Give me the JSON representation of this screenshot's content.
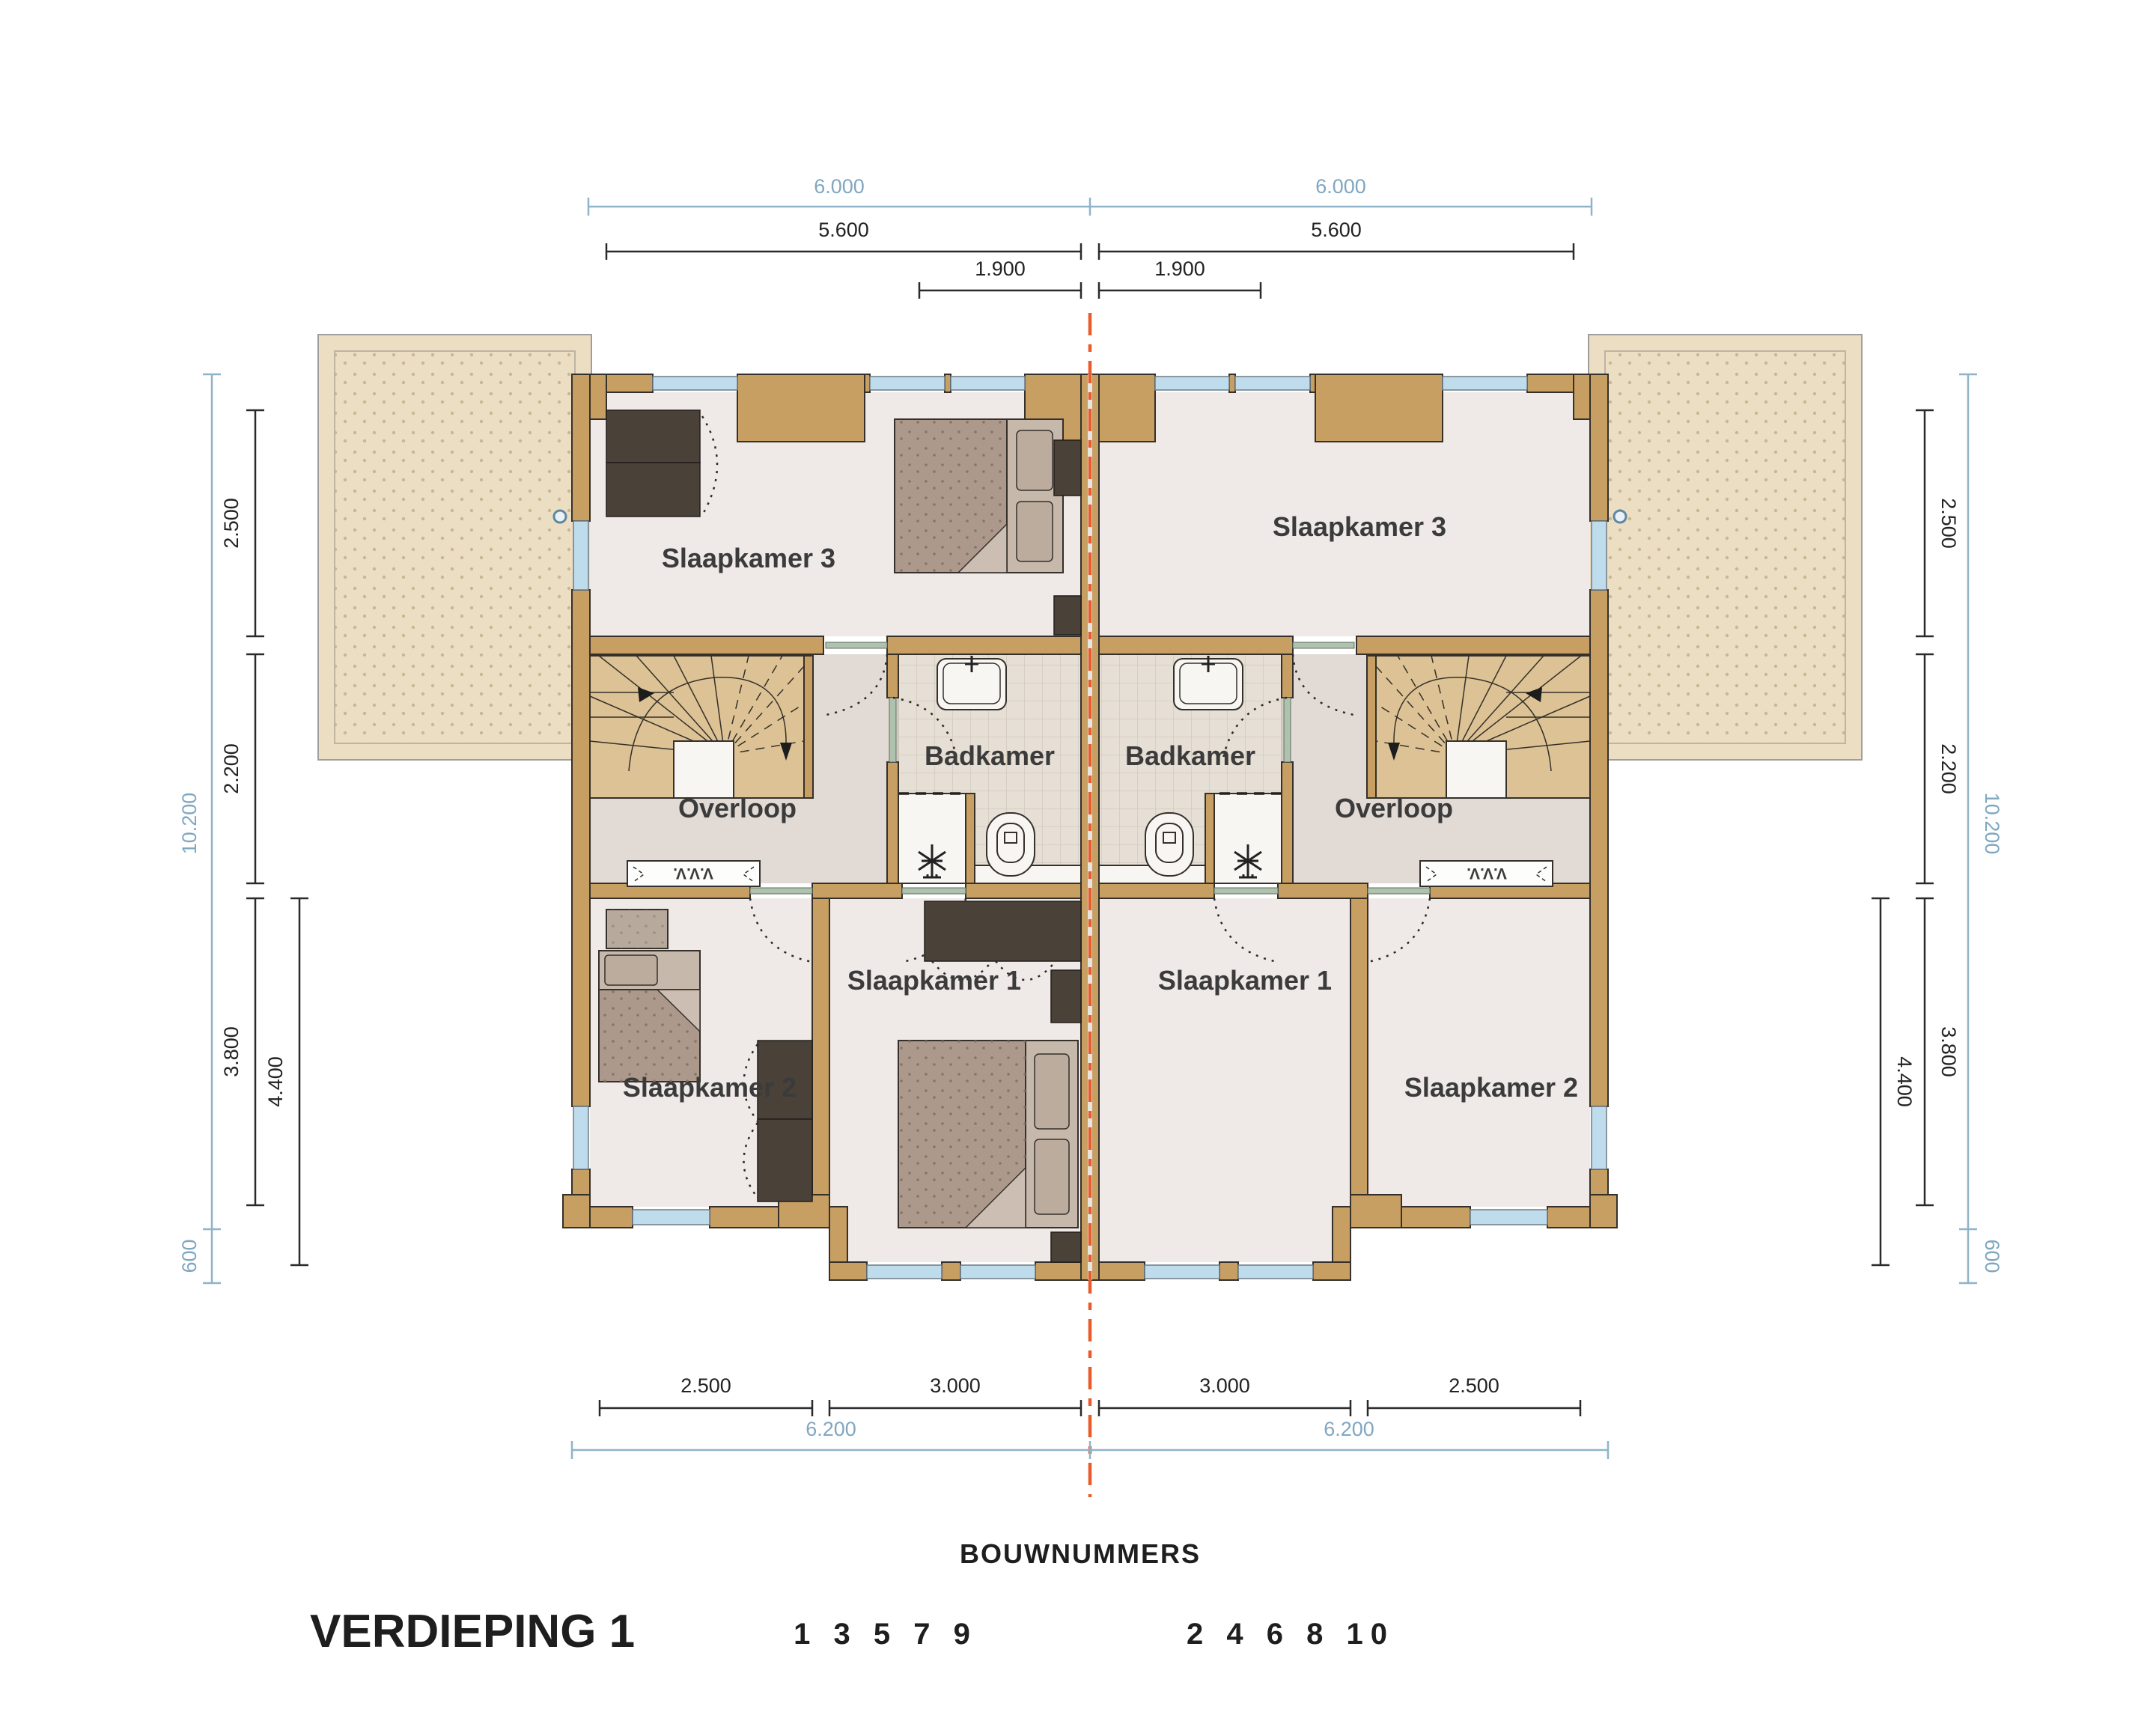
{
  "plan_title": "VERDIEPING 1",
  "bouwnummers": {
    "heading": "BOUWNUMMERS",
    "odd_numbers": "1 3 5 7 9",
    "even_numbers": "2 4 6 8 10"
  },
  "houses": {
    "left": {
      "bedroom3": "Slaapkamer 3",
      "bathroom": "Badkamer",
      "landing": "Overloop",
      "bedroom1": "Slaapkamer 1",
      "bedroom2": "Slaapkamer 2",
      "vent_unit": "V.V.V."
    },
    "right": {
      "bedroom3": "Slaapkamer 3",
      "bathroom": "Badkamer",
      "landing": "Overloop",
      "bedroom1": "Slaapkamer 1",
      "bedroom2": "Slaapkamer 2",
      "vent_unit": "V.V.V."
    }
  },
  "dimensions": {
    "top": [
      {
        "value": "6.000"
      },
      {
        "value": "6.000"
      },
      {
        "value": "5.600"
      },
      {
        "value": "5.600"
      },
      {
        "value": "1.900"
      },
      {
        "value": "1.900"
      }
    ],
    "left": [
      {
        "value": "2.500"
      },
      {
        "value": "2.200"
      },
      {
        "value": "3.800"
      },
      {
        "value": "4.400"
      },
      {
        "value": "10.200"
      },
      {
        "value": "600"
      }
    ],
    "right": [
      {
        "value": "2.500"
      },
      {
        "value": "2.200"
      },
      {
        "value": "3.800"
      },
      {
        "value": "4.400"
      },
      {
        "value": "10.200"
      },
      {
        "value": "600"
      }
    ],
    "bottom": [
      {
        "value": "2.500"
      },
      {
        "value": "3.000"
      },
      {
        "value": "3.000"
      },
      {
        "value": "2.500"
      },
      {
        "value": "6.200"
      },
      {
        "value": "6.200"
      }
    ]
  },
  "colors": {
    "wall": "#C89F63",
    "window_glass": "#BFDCEC",
    "room_floor": "#EFEAE7",
    "landing_floor": "#E2DAD4",
    "bathroom_tile": "#E6DFD5",
    "terrace": "#ECDEC3",
    "furniture_dark": "#4A4138",
    "bed": "#AC998B",
    "party_line_orange": "#E85C2C",
    "dimension_blue": "#8FB3C9",
    "dimension_black": "#2A2A2A",
    "label_text": "#3B3B3B"
  }
}
